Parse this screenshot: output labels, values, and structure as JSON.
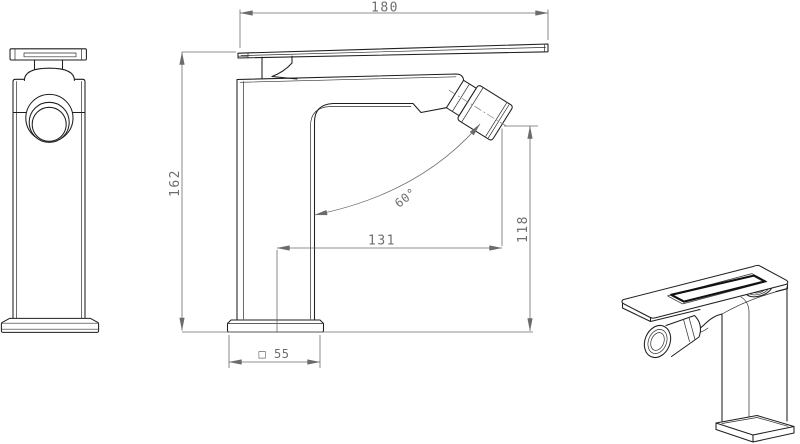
{
  "colors": {
    "background": "#ffffff",
    "object_line": "#1f1f1f",
    "dimension_line": "#6b6b6b"
  },
  "dimensions": {
    "lever_length": "180",
    "overall_height": "162",
    "spout_reach": "131",
    "outlet_height": "118",
    "spout_angle": "60°",
    "base_square": "□ 55"
  }
}
